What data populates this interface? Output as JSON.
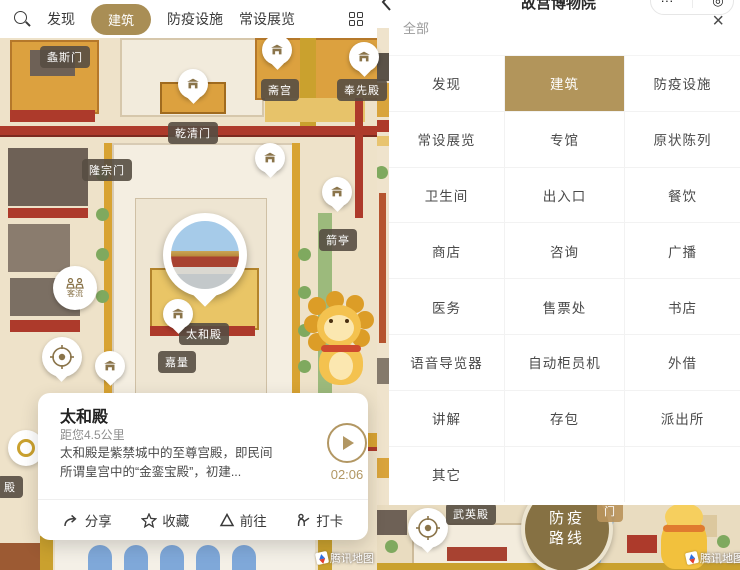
{
  "colors": {
    "accent_gold": "#a98e55",
    "selected_cell_gold": "#b2955b",
    "label_chip": "#564e42",
    "time_gold": "#b29763",
    "map_base": "#eee2c9"
  },
  "left": {
    "tabbar": {
      "search_icon": "magnifier",
      "tabs": [
        {
          "label": "发现",
          "name": "discover",
          "selected": false
        },
        {
          "label": "建筑",
          "name": "architecture",
          "selected": true
        },
        {
          "label": "防疫设施",
          "name": "epidemic-facilities",
          "selected": false
        },
        {
          "label": "常设展览",
          "name": "permanent-exhibitions",
          "selected": false
        }
      ],
      "grid_icon": "category-grid"
    },
    "map": {
      "chips": [
        {
          "text": "螽斯门",
          "name": "zhongsi-gate",
          "x": 65,
          "y": 57
        },
        {
          "text": "斋宫",
          "name": "zhai-palace",
          "x": 280,
          "y": 90
        },
        {
          "text": "奉先殿",
          "name": "fengxian-hall",
          "x": 362,
          "y": 90
        },
        {
          "text": "乾清门",
          "name": "qianqing-gate",
          "x": 193,
          "y": 133
        },
        {
          "text": "隆宗门",
          "name": "longzong-gate",
          "x": 107,
          "y": 170
        },
        {
          "text": "箭亭",
          "name": "jian-pavilion",
          "x": 338,
          "y": 240
        },
        {
          "text": "太和殿",
          "name": "taihe-hall",
          "x": 204,
          "y": 334
        },
        {
          "text": "嘉量",
          "name": "jialiang",
          "x": 177,
          "y": 362
        },
        {
          "text": "殿",
          "name": "partial-hall-label",
          "x": 10,
          "y": 487
        }
      ],
      "pins": [
        {
          "x": 193,
          "y": 84
        },
        {
          "x": 277,
          "y": 50
        },
        {
          "x": 270,
          "y": 158
        },
        {
          "x": 337,
          "y": 192
        },
        {
          "x": 178,
          "y": 314
        },
        {
          "x": 110,
          "y": 366
        },
        {
          "x": 364,
          "y": 57
        }
      ],
      "crowd_marker_label": "客流",
      "selected_poi": "太和殿"
    },
    "card": {
      "title": "太和殿",
      "distance": "距您4.5公里",
      "description_line1": "太和殿是紫禁城中的至尊宫殿，即民间",
      "description_line2": "所谓皇宫中的“金銮宝殿”，初建...",
      "audio_duration": "02:06",
      "actions": [
        {
          "label": "分享",
          "name": "share",
          "icon": "share-icon"
        },
        {
          "label": "收藏",
          "name": "favorite",
          "icon": "star-icon"
        },
        {
          "label": "前往",
          "name": "navigate",
          "icon": "navigate-icon"
        },
        {
          "label": "打卡",
          "name": "check-in",
          "icon": "checkin-icon"
        }
      ]
    },
    "attribution": "腾讯地图"
  },
  "right": {
    "header": {
      "title": "故宫博物院",
      "capsule": {
        "more": "···",
        "home": "◎"
      }
    },
    "filter_bar": {
      "all_label": "全部",
      "close_glyph": "×"
    },
    "grid": {
      "selected": "建筑",
      "rows": [
        [
          {
            "label": "发现",
            "name": "discover"
          },
          {
            "label": "建筑",
            "name": "architecture"
          },
          {
            "label": "防疫设施",
            "name": "epidemic-facilities"
          }
        ],
        [
          {
            "label": "常设展览",
            "name": "permanent-exhibitions"
          },
          {
            "label": "专馆",
            "name": "special-halls"
          },
          {
            "label": "原状陈列",
            "name": "original-state-display"
          }
        ],
        [
          {
            "label": "卫生间",
            "name": "restroom"
          },
          {
            "label": "出入口",
            "name": "entrance-exit"
          },
          {
            "label": "餐饮",
            "name": "dining"
          }
        ],
        [
          {
            "label": "商店",
            "name": "shop"
          },
          {
            "label": "咨询",
            "name": "consultation"
          },
          {
            "label": "广播",
            "name": "broadcast"
          }
        ],
        [
          {
            "label": "医务",
            "name": "medical"
          },
          {
            "label": "售票处",
            "name": "ticket-office"
          },
          {
            "label": "书店",
            "name": "bookstore"
          }
        ],
        [
          {
            "label": "语音导览器",
            "name": "audio-guide"
          },
          {
            "label": "自动柜员机",
            "name": "atm"
          },
          {
            "label": "外借",
            "name": "lending"
          }
        ],
        [
          {
            "label": "讲解",
            "name": "guide-service"
          },
          {
            "label": "存包",
            "name": "locker"
          },
          {
            "label": "派出所",
            "name": "police-station"
          }
        ],
        [
          {
            "label": "其它",
            "name": "other"
          },
          {
            "label": "",
            "name": "empty-1"
          },
          {
            "label": "",
            "name": "empty-2"
          }
        ]
      ]
    },
    "map": {
      "chips": [
        {
          "text": "武英殿",
          "name": "wuying-hall",
          "x": 471,
          "y": 514,
          "lite": false
        },
        {
          "text": "门",
          "name": "gate-partial",
          "x": 610,
          "y": 511,
          "lite": true
        }
      ],
      "route_badge": {
        "line1": "防疫",
        "line2": "路线"
      },
      "attribution": "腾讯地图"
    }
  }
}
